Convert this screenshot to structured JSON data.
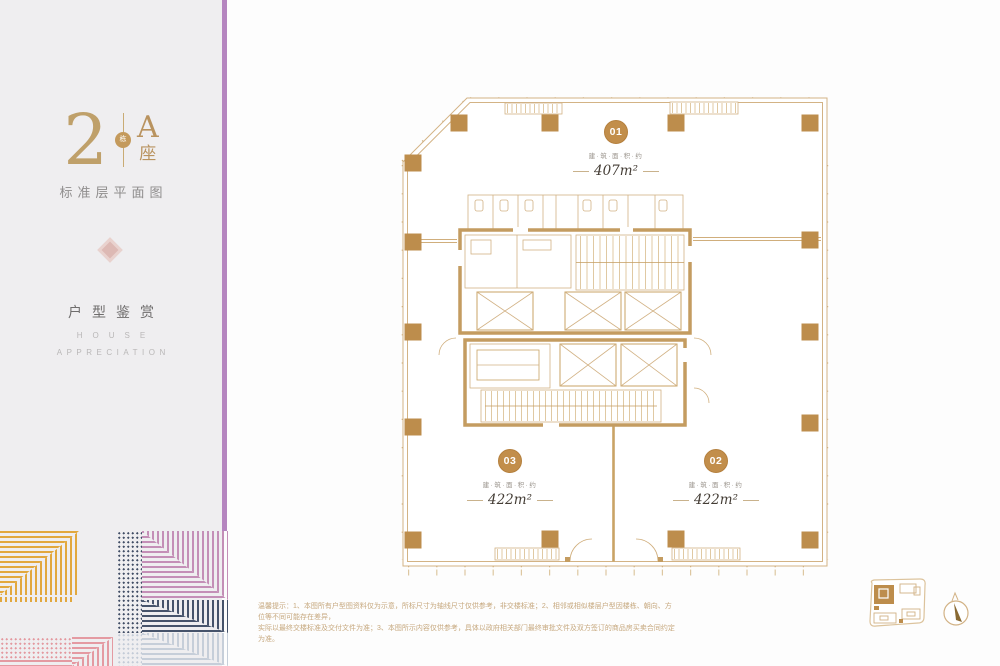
{
  "sidebar": {
    "building_number": "2",
    "badge": "栋",
    "block_letter": "A",
    "block_suffix": "座",
    "plan_title": "标准层平面图",
    "section_title": "户型鉴赏",
    "section_en1": "HOUSE",
    "section_en2": "APPRECIATION"
  },
  "plan": {
    "units": [
      {
        "id": "01",
        "label": "建·筑·面·积·约",
        "area": "407m²"
      },
      {
        "id": "02",
        "label": "建·筑·面·积·约",
        "area": "422m²"
      },
      {
        "id": "03",
        "label": "建·筑·面·积·约",
        "area": "422m²"
      }
    ]
  },
  "footer": {
    "line1": "温馨提示：1、本图所有户型图资料仅为示意，所标尺寸为轴线尺寸仅供参考，非交楼标准；2、相邻或相似楼层户型因楼栋、朝向、方位等不同可能存在差异，",
    "line2": "实际以最终交楼标准及交付文件为准；3、本图所示内容仅供参考，具体以政府相关部门最终审批文件及双方签订的商品房买卖合同约定为准。"
  },
  "icons": {
    "keyplan": "site-key-plan",
    "compass": "north-compass"
  },
  "colors": {
    "accent_gold": "#bd8d4c",
    "accent_purple": "#b585bf",
    "pattern_gold": "#e2a83e",
    "pattern_mauve": "#c48fb7",
    "pattern_navy": "#46536b",
    "pattern_pink": "#e49aa2",
    "pattern_gray": "#c6ced9"
  }
}
